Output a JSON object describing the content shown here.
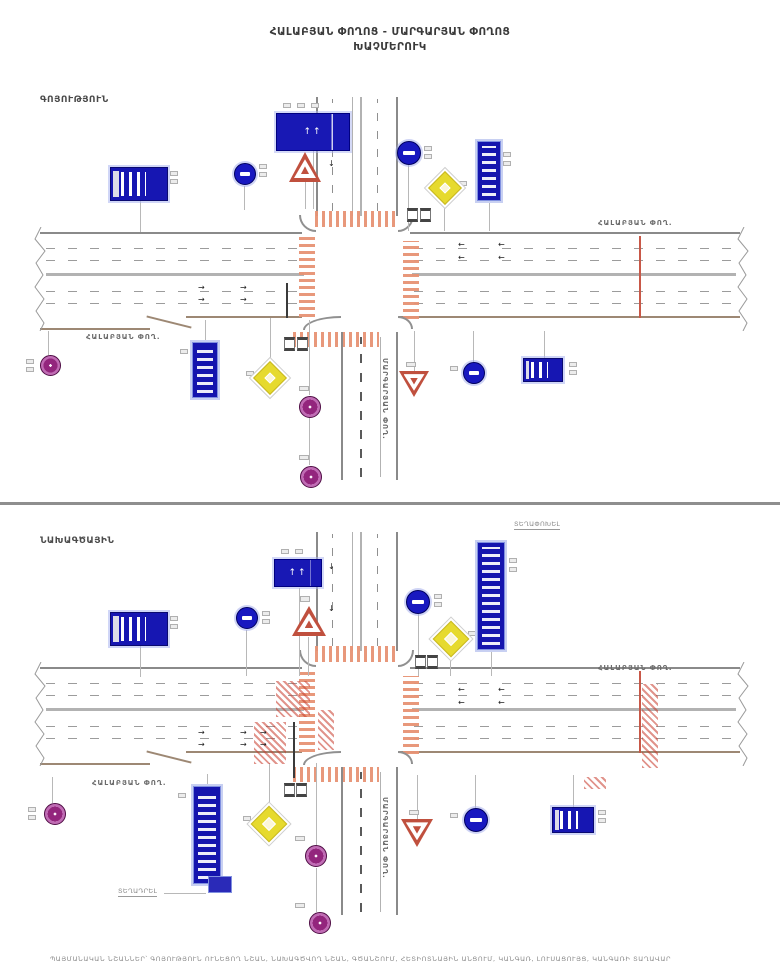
{
  "title": {
    "line1": "ՀԱԼԱԲՅԱՆ ՓՈՂՈՑ - ՄԱՐԳԱՐՅԱՆ ՓՈՂՈՑ",
    "line2": "ԽԱՉՄԵՐՈՒԿ"
  },
  "footer": {
    "text": "ՊԱՅՄԱՆԱԿԱՆ ՆՇԱՆՆԵՐ՝ ԳՈՅՈՒԹՅՈՒՆ ՈՒՆԵՑՈՂ ՆՇԱՆ, ՆԱԽԱԳԾՎՈՂ ՆՇԱՆ, ԳԾԱՆՇՈՒՄ, ՀԵՏԻՈՏՆԱՅԻՆ ԱՆՑՈՒՄ, ԿԱՆԳԱՌ, ԼՈՒՍԱՑՈՒՅՑ, ԿԱՆԳԱՌԻ ՏԱՂԱՎԱՐ"
  },
  "colors": {
    "sign_blue": "#1616b2",
    "marking_orange": "#e79274",
    "hatch_red": "#c83c2d",
    "sign_purple": "#93267d",
    "sign_yellow": "#e6da2e",
    "triangle_red": "#c0503e",
    "road_gray": "#8a8a8a",
    "divider_gray": "#8e8e8e"
  },
  "panels": [
    {
      "id": "existing",
      "label": "ԳՈՅՈՒԹՅՈՒՆ",
      "elements": [
        {
          "c": "lnd",
          "x": 286,
          "y": 283,
          "w": 2,
          "h": 35
        },
        {
          "c": "ln",
          "x": 140,
          "y": 201,
          "w": 1,
          "h": 31
        },
        {
          "c": "ln",
          "x": 313,
          "y": 151,
          "w": 1,
          "h": 58
        },
        {
          "c": "ln",
          "x": 244,
          "y": 186,
          "w": 1,
          "h": 24
        },
        {
          "c": "ln",
          "x": 305,
          "y": 182,
          "w": 1,
          "h": 27
        },
        {
          "c": "ln",
          "x": 408,
          "y": 165,
          "w": 1,
          "h": 66
        },
        {
          "c": "ln",
          "x": 444,
          "y": 200,
          "w": 1,
          "h": 31
        },
        {
          "c": "ln",
          "x": 489,
          "y": 201,
          "w": 1,
          "h": 30
        },
        {
          "c": "ln",
          "x": 205,
          "y": 320,
          "w": 1,
          "h": 22
        },
        {
          "c": "ln",
          "x": 270,
          "y": 318,
          "w": 1,
          "h": 48
        },
        {
          "c": "ln",
          "x": 309,
          "y": 320,
          "w": 1,
          "h": 75
        },
        {
          "c": "ln",
          "x": 309,
          "y": 417,
          "w": 1,
          "h": 48
        },
        {
          "c": "ln",
          "x": 414,
          "y": 331,
          "w": 1,
          "h": 41
        },
        {
          "c": "ln",
          "x": 473,
          "y": 331,
          "w": 1,
          "h": 31
        },
        {
          "c": "ln",
          "x": 544,
          "y": 331,
          "w": 1,
          "h": 28
        },
        {
          "c": "ln",
          "x": 48,
          "y": 331,
          "w": 1,
          "h": 24
        },
        {
          "c": "arr",
          "x": 198,
          "y": 284,
          "t": "→"
        },
        {
          "c": "arr",
          "x": 240,
          "y": 284,
          "t": "→"
        },
        {
          "c": "arr",
          "x": 198,
          "y": 296,
          "t": "→"
        },
        {
          "c": "arr",
          "x": 240,
          "y": 296,
          "t": "→"
        },
        {
          "c": "arr",
          "x": 458,
          "y": 241,
          "t": "←"
        },
        {
          "c": "arr",
          "x": 498,
          "y": 241,
          "t": "←"
        },
        {
          "c": "arr",
          "x": 458,
          "y": 254,
          "t": "←"
        },
        {
          "c": "arr",
          "x": 498,
          "y": 254,
          "t": "←"
        },
        {
          "c": "arr",
          "x": 328,
          "y": 118,
          "t": "↓"
        },
        {
          "c": "arr",
          "x": 328,
          "y": 160,
          "t": "↓"
        },
        {
          "c": "tag",
          "x": 170,
          "y": 171
        },
        {
          "c": "tag",
          "x": 170,
          "y": 179
        },
        {
          "c": "tag",
          "x": 259,
          "y": 164
        },
        {
          "c": "tag",
          "x": 259,
          "y": 172
        },
        {
          "c": "tag",
          "x": 283,
          "y": 103
        },
        {
          "c": "tag",
          "x": 297,
          "y": 103
        },
        {
          "c": "tag",
          "x": 311,
          "y": 103
        },
        {
          "c": "tag",
          "x": 298,
          "y": 140,
          "w": 10,
          "h": 6
        },
        {
          "c": "tag",
          "x": 424,
          "y": 146
        },
        {
          "c": "tag",
          "x": 424,
          "y": 154
        },
        {
          "c": "tag",
          "x": 459,
          "y": 181
        },
        {
          "c": "tag",
          "x": 503,
          "y": 152
        },
        {
          "c": "tag",
          "x": 503,
          "y": 161
        },
        {
          "c": "tag",
          "x": 180,
          "y": 349
        },
        {
          "c": "tag",
          "x": 246,
          "y": 371
        },
        {
          "c": "tag",
          "x": 299,
          "y": 386,
          "w": 10,
          "h": 5
        },
        {
          "c": "tag",
          "x": 299,
          "y": 455,
          "w": 10,
          "h": 5
        },
        {
          "c": "tag",
          "x": 406,
          "y": 362,
          "w": 10,
          "h": 5
        },
        {
          "c": "tag",
          "x": 450,
          "y": 366
        },
        {
          "c": "tag",
          "x": 569,
          "y": 362
        },
        {
          "c": "tag",
          "x": 569,
          "y": 370
        },
        {
          "c": "tag",
          "x": 26,
          "y": 359
        },
        {
          "c": "tag",
          "x": 26,
          "y": 367
        },
        {
          "c": "bx",
          "x": 407,
          "y": 208,
          "w": 11,
          "h": 14
        },
        {
          "c": "bx",
          "x": 420,
          "y": 208,
          "w": 11,
          "h": 14
        },
        {
          "c": "bx",
          "x": 284,
          "y": 337,
          "w": 11,
          "h": 14
        },
        {
          "c": "bx",
          "x": 297,
          "y": 337,
          "w": 11,
          "h": 14
        },
        {
          "n": "bus-stop-sign-nw",
          "c": "sign-bus",
          "x": 110,
          "y": 167,
          "w": 58,
          "h": 34
        },
        {
          "n": "lane-directions-sign-n",
          "c": "sign-lanes",
          "x": 276,
          "y": 113,
          "w": 74,
          "h": 38,
          "t": "↑↑"
        },
        {
          "n": "round-sign-blue-nw",
          "c": "circle-blue",
          "x": 234,
          "y": 163,
          "w": 22,
          "h": 22
        },
        {
          "n": "warning-triangle-n",
          "c": "tri-up",
          "x": 289,
          "y": 152,
          "w": 32,
          "h": 30
        },
        {
          "n": "round-sign-blue-ne",
          "c": "circle-blue",
          "x": 397,
          "y": 141,
          "w": 24,
          "h": 24
        },
        {
          "n": "priority-diamond-ne",
          "c": "diamond-yellow",
          "x": 433,
          "y": 176,
          "w": 24,
          "h": 24
        },
        {
          "n": "street-name-sign-ne",
          "c": "sign-name-v",
          "x": 477,
          "y": 141,
          "w": 24,
          "h": 60
        },
        {
          "n": "street-name-sign-s",
          "c": "sign-name-v",
          "x": 192,
          "y": 342,
          "w": 26,
          "h": 56
        },
        {
          "n": "priority-diamond-sw",
          "c": "diamond-yellow",
          "x": 258,
          "y": 366,
          "w": 24,
          "h": 24
        },
        {
          "n": "round-sign-purple-s1",
          "c": "circle-purple",
          "x": 299,
          "y": 396,
          "w": 22,
          "h": 22
        },
        {
          "n": "round-sign-purple-s2",
          "c": "circle-purple",
          "x": 300,
          "y": 466,
          "w": 22,
          "h": 22
        },
        {
          "n": "yield-triangle-s",
          "c": "tri-down",
          "x": 399,
          "y": 371,
          "w": 30,
          "h": 26
        },
        {
          "n": "round-sign-blue-s",
          "c": "circle-blue",
          "x": 463,
          "y": 362,
          "w": 22,
          "h": 22
        },
        {
          "n": "bus-stop-sign-se",
          "c": "sign-bus",
          "x": 523,
          "y": 358,
          "w": 40,
          "h": 24
        },
        {
          "n": "round-sign-purple-w",
          "c": "circle-purple",
          "x": 40,
          "y": 355,
          "w": 21,
          "h": 21
        },
        {
          "n": "street-label-east",
          "c": "lbl",
          "x": 598,
          "y": 219,
          "t": "ՀԱԼԱԲՅԱՆ ՓՈՂ."
        },
        {
          "n": "street-label-west",
          "c": "lbl",
          "x": 86,
          "y": 333,
          "t": "ՀԱԼԱԲՅԱՆ ՓՈՂ."
        },
        {
          "n": "street-label-south",
          "c": "lbl lbl-v",
          "x": 389,
          "y": 358,
          "t": "ՄԱՐԳԱՐՅԱՆ ՓՈՂ.",
          "r": 90
        }
      ]
    },
    {
      "id": "design",
      "label": "ՆԱԽԱԳԾԱՅԻՆ",
      "elements": [
        {
          "c": "lnd",
          "x": 293,
          "y": 722,
          "w": 2,
          "h": 56
        },
        {
          "c": "ln",
          "x": 140,
          "y": 646,
          "w": 1,
          "h": 31
        },
        {
          "c": "ln",
          "x": 299,
          "y": 588,
          "w": 1,
          "h": 88
        },
        {
          "c": "ln",
          "x": 246,
          "y": 630,
          "w": 1,
          "h": 46
        },
        {
          "c": "ln",
          "x": 308,
          "y": 637,
          "w": 1,
          "h": 39
        },
        {
          "c": "ln",
          "x": 418,
          "y": 614,
          "w": 1,
          "h": 62
        },
        {
          "c": "ln",
          "x": 450,
          "y": 653,
          "w": 1,
          "h": 23
        },
        {
          "c": "ln",
          "x": 491,
          "y": 651,
          "w": 1,
          "h": 25
        },
        {
          "c": "ln",
          "x": 207,
          "y": 774,
          "w": 1,
          "h": 13
        },
        {
          "c": "ln",
          "x": 269,
          "y": 763,
          "w": 1,
          "h": 49
        },
        {
          "c": "ln",
          "x": 316,
          "y": 763,
          "w": 1,
          "h": 82
        },
        {
          "c": "ln",
          "x": 316,
          "y": 868,
          "w": 1,
          "h": 44
        },
        {
          "c": "ln",
          "x": 417,
          "y": 775,
          "w": 1,
          "h": 45
        },
        {
          "c": "ln",
          "x": 475,
          "y": 775,
          "w": 1,
          "h": 33
        },
        {
          "c": "ln",
          "x": 573,
          "y": 775,
          "w": 1,
          "h": 32
        },
        {
          "c": "ln",
          "x": 52,
          "y": 777,
          "w": 1,
          "h": 26
        },
        {
          "c": "ln",
          "x": 164,
          "y": 893,
          "w": 42,
          "h": 1
        },
        {
          "c": "hatch-red",
          "x": 276,
          "y": 681,
          "w": 34,
          "h": 36
        },
        {
          "c": "hatch-red",
          "x": 254,
          "y": 722,
          "w": 32,
          "h": 42
        },
        {
          "c": "hatch-red",
          "x": 318,
          "y": 710,
          "w": 16,
          "h": 40
        },
        {
          "c": "hatch-red",
          "x": 642,
          "y": 684,
          "w": 16,
          "h": 84
        },
        {
          "c": "hatch-red",
          "x": 584,
          "y": 777,
          "w": 22,
          "h": 12
        },
        {
          "c": "arr",
          "x": 198,
          "y": 729,
          "t": "→"
        },
        {
          "c": "arr",
          "x": 240,
          "y": 729,
          "t": "→"
        },
        {
          "c": "arr",
          "x": 260,
          "y": 729,
          "t": "→"
        },
        {
          "c": "arr",
          "x": 198,
          "y": 741,
          "t": "→"
        },
        {
          "c": "arr",
          "x": 240,
          "y": 741,
          "t": "→"
        },
        {
          "c": "arr",
          "x": 260,
          "y": 741,
          "t": "→"
        },
        {
          "c": "arr",
          "x": 458,
          "y": 686,
          "t": "←"
        },
        {
          "c": "arr",
          "x": 498,
          "y": 686,
          "t": "←"
        },
        {
          "c": "arr",
          "x": 458,
          "y": 699,
          "t": "←"
        },
        {
          "c": "arr",
          "x": 498,
          "y": 699,
          "t": "←"
        },
        {
          "c": "arr",
          "x": 328,
          "y": 563,
          "t": "↓"
        },
        {
          "c": "arr",
          "x": 328,
          "y": 605,
          "t": "↓"
        },
        {
          "c": "tag",
          "x": 170,
          "y": 616
        },
        {
          "c": "tag",
          "x": 170,
          "y": 624
        },
        {
          "c": "tag",
          "x": 262,
          "y": 611
        },
        {
          "c": "tag",
          "x": 262,
          "y": 619
        },
        {
          "c": "tag",
          "x": 281,
          "y": 549
        },
        {
          "c": "tag",
          "x": 295,
          "y": 549
        },
        {
          "c": "tag",
          "x": 300,
          "y": 596,
          "w": 10,
          "h": 6
        },
        {
          "c": "tag",
          "x": 434,
          "y": 594
        },
        {
          "c": "tag",
          "x": 434,
          "y": 602
        },
        {
          "c": "tag",
          "x": 468,
          "y": 631
        },
        {
          "c": "tag",
          "x": 509,
          "y": 558
        },
        {
          "c": "tag",
          "x": 509,
          "y": 567
        },
        {
          "c": "tag",
          "x": 178,
          "y": 793
        },
        {
          "c": "tag",
          "x": 243,
          "y": 816
        },
        {
          "c": "tag",
          "x": 295,
          "y": 836,
          "w": 10,
          "h": 5
        },
        {
          "c": "tag",
          "x": 295,
          "y": 903,
          "w": 10,
          "h": 5
        },
        {
          "c": "tag",
          "x": 409,
          "y": 810,
          "w": 10,
          "h": 5
        },
        {
          "c": "tag",
          "x": 450,
          "y": 813
        },
        {
          "c": "tag",
          "x": 598,
          "y": 810
        },
        {
          "c": "tag",
          "x": 598,
          "y": 818
        },
        {
          "c": "tag",
          "x": 28,
          "y": 807
        },
        {
          "c": "tag",
          "x": 28,
          "y": 815
        },
        {
          "c": "bx",
          "x": 415,
          "y": 655,
          "w": 11,
          "h": 14
        },
        {
          "c": "bx",
          "x": 427,
          "y": 655,
          "w": 11,
          "h": 14
        },
        {
          "c": "bx",
          "x": 284,
          "y": 783,
          "w": 11,
          "h": 14
        },
        {
          "c": "bx",
          "x": 296,
          "y": 783,
          "w": 11,
          "h": 14
        },
        {
          "n": "bus-stop-sign-nw",
          "c": "sign-bus",
          "x": 110,
          "y": 612,
          "w": 58,
          "h": 34
        },
        {
          "n": "lane-directions-sign-n",
          "c": "sign-lanes",
          "x": 274,
          "y": 559,
          "w": 48,
          "h": 28,
          "t": "↑↑"
        },
        {
          "n": "round-sign-blue-nw",
          "c": "circle-blue",
          "x": 236,
          "y": 607,
          "w": 22,
          "h": 22
        },
        {
          "n": "warning-triangle-n",
          "c": "tri-up",
          "x": 292,
          "y": 606,
          "w": 34,
          "h": 30
        },
        {
          "n": "round-sign-blue-ne",
          "c": "circle-blue",
          "x": 406,
          "y": 590,
          "w": 24,
          "h": 24
        },
        {
          "n": "priority-diamond-ne",
          "c": "diamond-yellow",
          "x": 438,
          "y": 626,
          "w": 26,
          "h": 26
        },
        {
          "n": "street-name-sign-ne",
          "c": "sign-name-v",
          "x": 477,
          "y": 542,
          "w": 28,
          "h": 108
        },
        {
          "n": "street-name-sign-s",
          "c": "sign-name-v",
          "x": 193,
          "y": 786,
          "w": 28,
          "h": 98
        },
        {
          "n": "priority-diamond-sw",
          "c": "diamond-yellow",
          "x": 256,
          "y": 811,
          "w": 26,
          "h": 26
        },
        {
          "n": "round-sign-purple-w",
          "c": "circle-purple",
          "x": 44,
          "y": 803,
          "w": 22,
          "h": 22
        },
        {
          "n": "round-sign-purple-s1",
          "c": "circle-purple",
          "x": 305,
          "y": 845,
          "w": 22,
          "h": 22
        },
        {
          "n": "round-sign-purple-s2",
          "c": "circle-purple",
          "x": 309,
          "y": 912,
          "w": 22,
          "h": 22
        },
        {
          "n": "yield-triangle-s",
          "c": "tri-down",
          "x": 401,
          "y": 819,
          "w": 32,
          "h": 28
        },
        {
          "n": "round-sign-blue-s",
          "c": "circle-blue",
          "x": 464,
          "y": 808,
          "w": 24,
          "h": 24
        },
        {
          "n": "bus-stop-sign-se",
          "c": "sign-bus",
          "x": 552,
          "y": 807,
          "w": 42,
          "h": 26
        },
        {
          "n": "installed-sign-chip",
          "c": "chip-blue",
          "x": 208,
          "y": 876,
          "w": 24,
          "h": 17
        },
        {
          "n": "street-label-east",
          "c": "lbl",
          "x": 598,
          "y": 664,
          "t": "ՀԱԼԱԲՅԱՆ ՓՈՂ."
        },
        {
          "n": "street-label-west",
          "c": "lbl",
          "x": 92,
          "y": 779,
          "t": "ՀԱԼԱԲՅԱՆ ՓՈՂ."
        },
        {
          "n": "street-label-south",
          "c": "lbl lbl-v",
          "x": 389,
          "y": 797,
          "t": "ՄԱՐԳԱՐՅԱՆ ՓՈՂ.",
          "r": 90
        },
        {
          "n": "note-relocate",
          "c": "lbl lbl-u",
          "x": 514,
          "y": 520,
          "t": "ՏԵՂԱՓՈԽԵԼ"
        },
        {
          "n": "note-install",
          "c": "lbl lbl-u",
          "x": 118,
          "y": 887,
          "t": "ՏԵՂԱԴՐԵԼ"
        }
      ]
    }
  ]
}
